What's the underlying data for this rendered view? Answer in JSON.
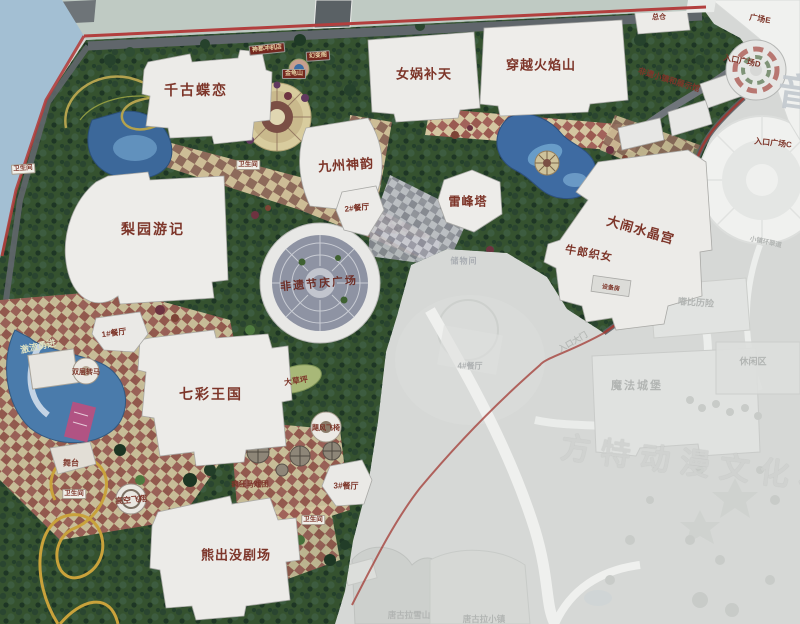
{
  "attractions": {
    "qiangu_dielian": "千古蝶恋",
    "nuwa_butian": "女娲补天",
    "chuanyue_huoyanshan": "穿越火焰山",
    "jiuzhou_shenyun": "九州神韵",
    "leifengta": "雷峰塔",
    "danao_shuijinggong": "大闹水晶宫",
    "niulang_zhinv": "牛郎织女",
    "liyuan_youji": "梨园游记",
    "qicai_wangguo": "七彩王国",
    "xiongchumo_juchang": "熊出没剧场",
    "feiyi_jieqing_guangchang": "非遗节庆广场",
    "feiyi_xiaozhen": "非遗小镇和展示馆"
  },
  "rides": {
    "jiliu_yongjin": "激流勇进",
    "shuangceng_zhuanma": "双层转马",
    "gaokong_feixiang": "高空飞翔",
    "fengkuang_maxituan": "疯狂马戏团",
    "jufeng_feiyi": "飓风飞椅",
    "wutai": "舞台",
    "dacaoping": "大草坪"
  },
  "facilities": {
    "restaurant_1": "1#餐厅",
    "restaurant_2": "2#餐厅",
    "restaurant_3": "3#餐厅",
    "restaurant_4": "4#餐厅",
    "toilet": "卫生间",
    "zongcang": "总仓",
    "chuwujian": "储物间",
    "shebeifang": "设备房"
  },
  "entrances": {
    "plaza_c": "入口广场C",
    "plaza_d": "入口广场D",
    "plaza_e": "广场E",
    "rukou_damen": "入口大门"
  },
  "adjacent_park": {
    "mofa_chengbao": "魔法城堡",
    "dubi_lixian": "嘟比历险",
    "xiuxianqu": "休闲区",
    "tanggula_xueshan": "唐古拉雪山",
    "tanggula_xiaozhen": "唐古拉小镇",
    "xiaozhen_huancuidao": "小镇环翠道",
    "watermark_fantawild": "方特动漫文化科技",
    "watermark_yin": "音"
  },
  "small_signs": {
    "sign_a": "神都冲机店",
    "sign_b": "幻变阁",
    "sign_c": "金龟山"
  },
  "colors": {
    "board_edge_red": "#b23f3e",
    "sky_blue": "#a3bfd3",
    "park_green": "#35522f",
    "faded_base": "#d6d8d6",
    "attraction_text": "#7d3529",
    "faded_text": "#b2b5b3"
  }
}
